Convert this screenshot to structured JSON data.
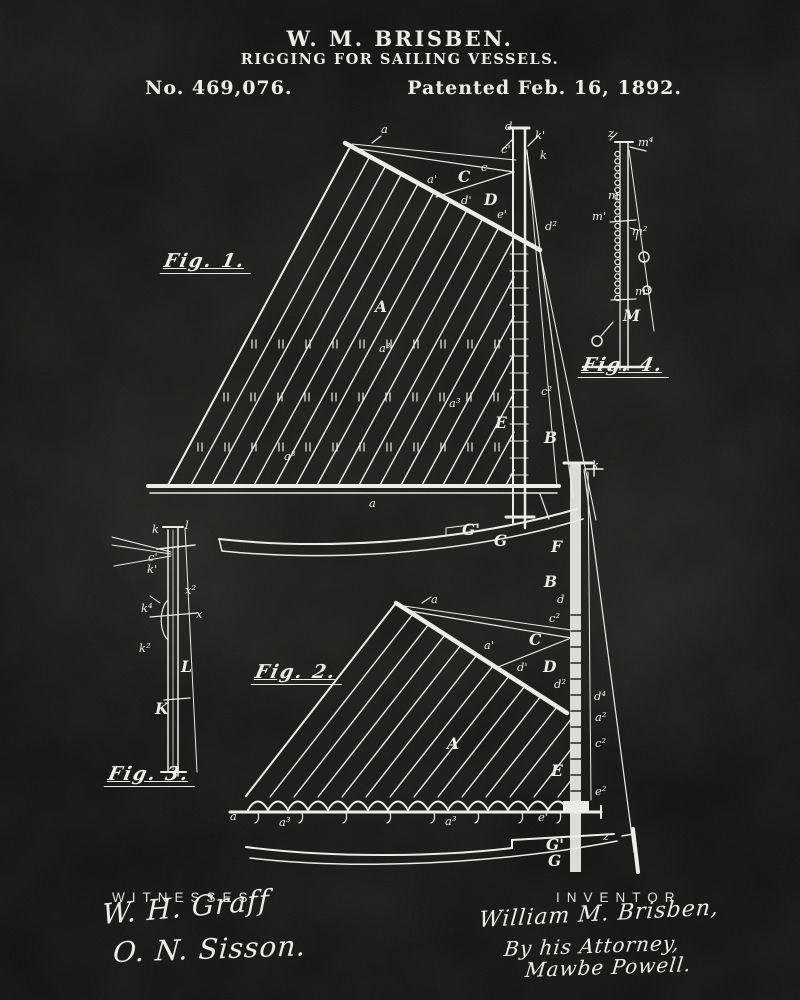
{
  "header": {
    "inventor_name": "W. M. BRISBEN.",
    "invention_title": "RIGGING FOR SAILING VESSELS.",
    "patent_number": "No. 469,076.",
    "patent_date": "Patented Feb. 16, 1892."
  },
  "colors": {
    "background": "#161614",
    "ink": "#eceae4"
  },
  "figures": {
    "fig1": {
      "caption": "Fig. 1.",
      "labels": [
        {
          "t": "a",
          "x": 381,
          "y": 133
        },
        {
          "t": "d",
          "x": 505,
          "y": 130
        },
        {
          "t": "k'",
          "x": 535,
          "y": 139
        },
        {
          "t": "c'",
          "x": 501,
          "y": 153
        },
        {
          "t": "k",
          "x": 540,
          "y": 159
        },
        {
          "t": "c",
          "x": 481,
          "y": 171
        },
        {
          "t": "C",
          "x": 458,
          "y": 182,
          "big": true
        },
        {
          "t": "a'",
          "x": 427,
          "y": 183
        },
        {
          "t": "d'",
          "x": 461,
          "y": 204
        },
        {
          "t": "D",
          "x": 484,
          "y": 205,
          "big": true
        },
        {
          "t": "e'",
          "x": 497,
          "y": 218
        },
        {
          "t": "d²",
          "x": 545,
          "y": 230
        },
        {
          "t": "A",
          "x": 375,
          "y": 312,
          "big": true
        },
        {
          "t": "a³",
          "x": 379,
          "y": 352
        },
        {
          "t": "a³",
          "x": 449,
          "y": 407
        },
        {
          "t": "a³",
          "x": 284,
          "y": 460
        },
        {
          "t": "c²",
          "x": 541,
          "y": 395
        },
        {
          "t": "E",
          "x": 495,
          "y": 428,
          "big": true
        },
        {
          "t": "B",
          "x": 544,
          "y": 443,
          "big": true
        },
        {
          "t": "a",
          "x": 369,
          "y": 507
        },
        {
          "t": "G'",
          "x": 462,
          "y": 535,
          "big": true
        },
        {
          "t": "G",
          "x": 494,
          "y": 546,
          "big": true
        }
      ]
    },
    "fig2": {
      "caption": "Fig. 2.",
      "labels": [
        {
          "t": "k",
          "x": 592,
          "y": 469
        },
        {
          "t": "F",
          "x": 551,
          "y": 552,
          "big": true
        },
        {
          "t": "B",
          "x": 544,
          "y": 587,
          "big": true
        },
        {
          "t": "d",
          "x": 557,
          "y": 603
        },
        {
          "t": "c²",
          "x": 549,
          "y": 622
        },
        {
          "t": "C",
          "x": 529,
          "y": 645,
          "big": true
        },
        {
          "t": "a",
          "x": 431,
          "y": 603
        },
        {
          "t": "a'",
          "x": 484,
          "y": 649
        },
        {
          "t": "d'",
          "x": 517,
          "y": 671
        },
        {
          "t": "D",
          "x": 543,
          "y": 672,
          "big": true
        },
        {
          "t": "d²",
          "x": 554,
          "y": 688
        },
        {
          "t": "A",
          "x": 447,
          "y": 749,
          "big": true
        },
        {
          "t": "d⁴",
          "x": 594,
          "y": 700
        },
        {
          "t": "a²",
          "x": 595,
          "y": 721
        },
        {
          "t": "c²",
          "x": 595,
          "y": 747
        },
        {
          "t": "E",
          "x": 551,
          "y": 776,
          "big": true
        },
        {
          "t": "e²",
          "x": 595,
          "y": 795
        },
        {
          "t": "a",
          "x": 230,
          "y": 820
        },
        {
          "t": "a³",
          "x": 279,
          "y": 826
        },
        {
          "t": "a³",
          "x": 445,
          "y": 825
        },
        {
          "t": "e'",
          "x": 538,
          "y": 821
        },
        {
          "t": "z",
          "x": 603,
          "y": 840
        },
        {
          "t": "G'",
          "x": 546,
          "y": 850,
          "big": true
        },
        {
          "t": "G",
          "x": 548,
          "y": 866,
          "big": true
        }
      ]
    },
    "fig3": {
      "caption": "Fig. 3.",
      "labels": [
        {
          "t": "k",
          "x": 152,
          "y": 533
        },
        {
          "t": "l",
          "x": 185,
          "y": 529
        },
        {
          "t": "c'",
          "x": 148,
          "y": 561
        },
        {
          "t": "k'",
          "x": 147,
          "y": 573
        },
        {
          "t": "x²",
          "x": 185,
          "y": 594
        },
        {
          "t": "k⁴",
          "x": 141,
          "y": 612
        },
        {
          "t": "x",
          "x": 196,
          "y": 618
        },
        {
          "t": "k²",
          "x": 139,
          "y": 652
        },
        {
          "t": "L",
          "x": 181,
          "y": 672,
          "big": true
        },
        {
          "t": "K",
          "x": 155,
          "y": 714,
          "big": true
        }
      ]
    },
    "fig4": {
      "caption": "Fig. 4.",
      "labels": [
        {
          "t": "z",
          "x": 608,
          "y": 137
        },
        {
          "t": "m⁴",
          "x": 638,
          "y": 146
        },
        {
          "t": "m",
          "x": 608,
          "y": 199
        },
        {
          "t": "m'",
          "x": 592,
          "y": 220
        },
        {
          "t": "m²",
          "x": 632,
          "y": 235
        },
        {
          "t": "m³",
          "x": 635,
          "y": 295
        },
        {
          "t": "M",
          "x": 623,
          "y": 321,
          "big": true
        }
      ]
    }
  },
  "footer": {
    "witnesses_heading": "WITNESSES",
    "witness_signatures": [
      "W. H. Graff",
      "O. N. Sisson."
    ],
    "inventor_heading": "INVENTOR",
    "inventor_signature_lines": [
      "William M. Brisben,",
      "By his Attorney,",
      "Mawbe Powell."
    ]
  }
}
